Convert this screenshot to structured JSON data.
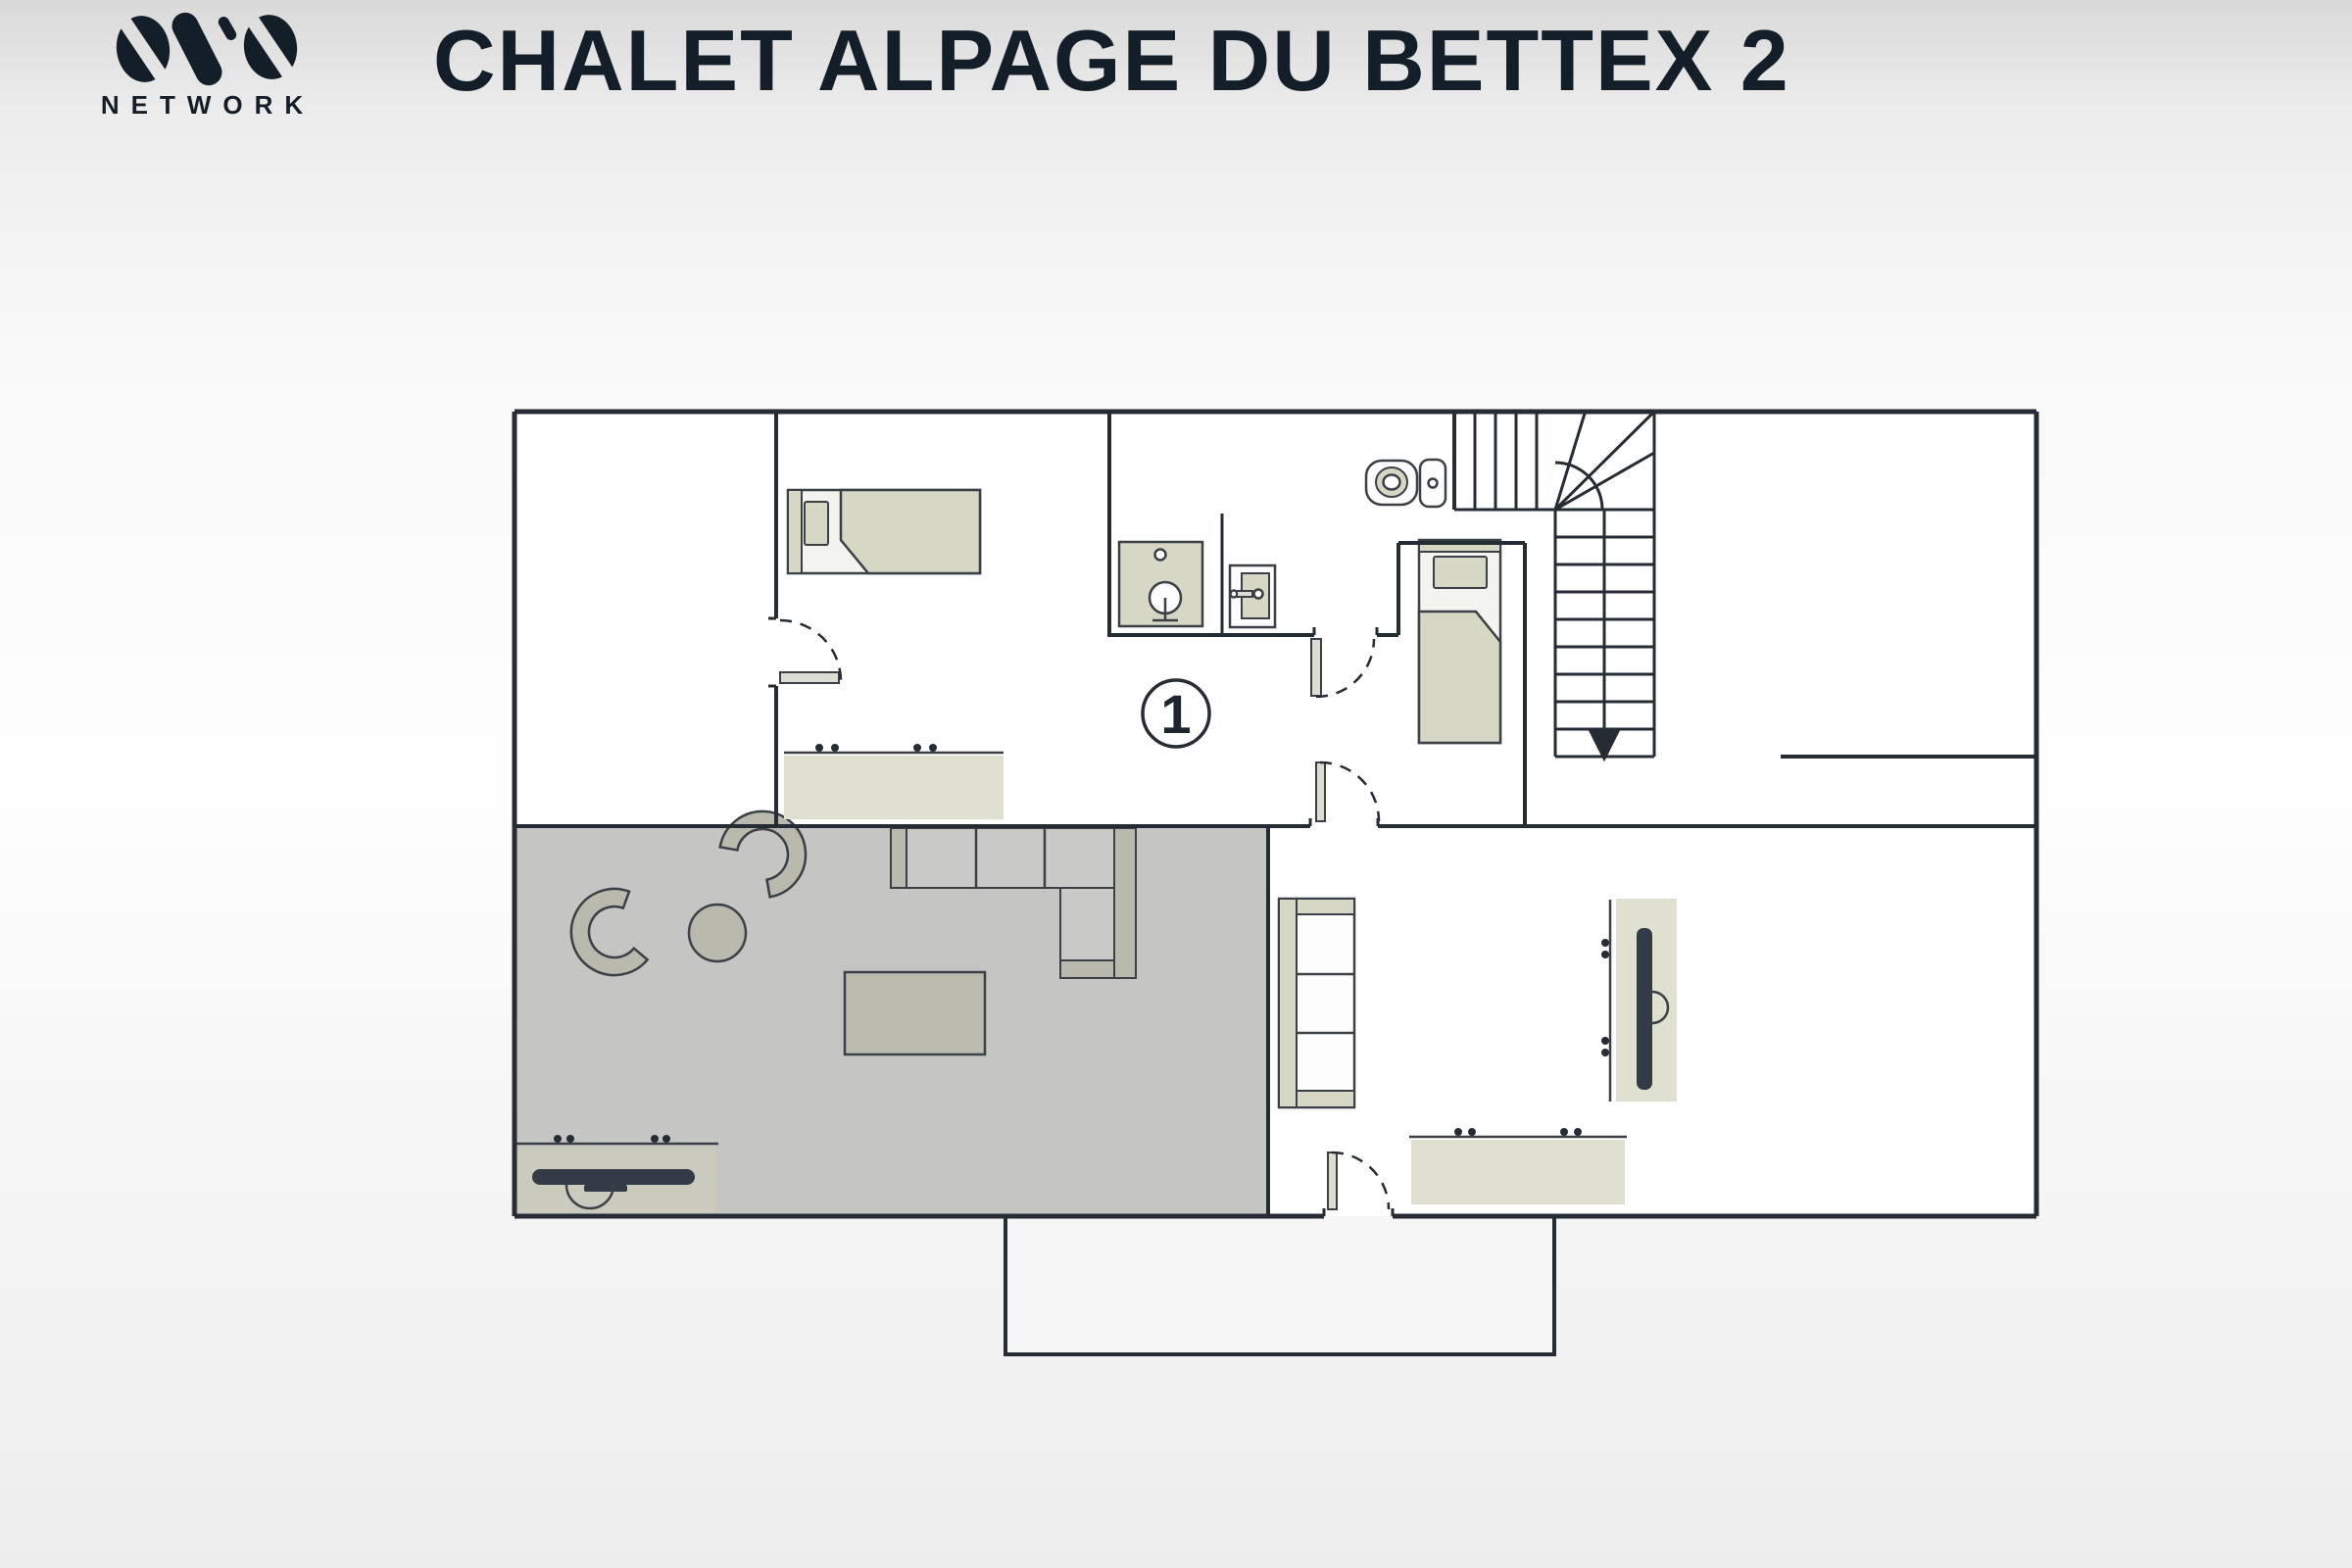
{
  "header": {
    "logo": {
      "mark": "ovo-mark",
      "wordmark": "NETWORK"
    },
    "title": "CHALET ALPAGE DU BETTEX 2"
  },
  "plan": {
    "floor_badge": "1",
    "furniture_icons": [
      "single-bed-horizontal",
      "single-bed-vertical",
      "dresser-with-knobs",
      "dresser-with-knobs",
      "shower-cabin",
      "washbasin",
      "toilet",
      "staircase-with-down-arrow",
      "sectional-sofa",
      "armchair",
      "armchair",
      "round-side-table",
      "coffee-table",
      "tv-console-with-tv",
      "bookshelf",
      "tv-sideboard-vertical",
      "door-swing",
      "door-swing",
      "door-swing",
      "door-swing"
    ]
  },
  "colors": {
    "wall": "#262c34",
    "outline": "#3b4046",
    "beige": "#d7d7c6",
    "beige_light": "#e0e0d1",
    "floor_gray": "#c5c5c4",
    "furn_gray": "#b9b9ae",
    "seat_gray": "#c9c9c8",
    "tv_dark": "#333c46",
    "fixture_white": "#fdfdfd",
    "ink": "#141e29",
    "badge_ink": "#1c242e",
    "room_white": "#ffffff",
    "annex_fill": "#f5f6f5",
    "leaf_fill": "#dcdcd2",
    "frame_fill": "#f3f3ef",
    "console_fill": "#cacabe"
  }
}
